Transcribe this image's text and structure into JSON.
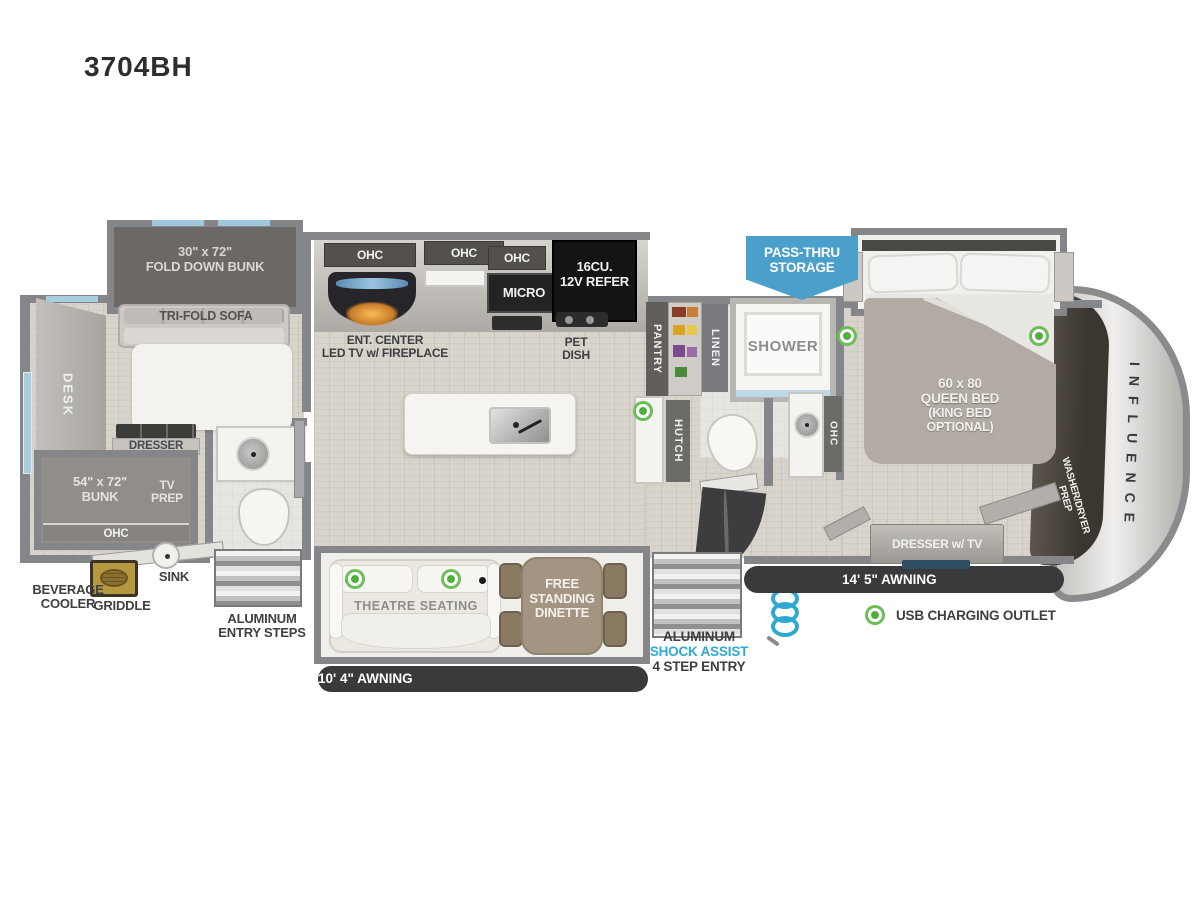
{
  "title": "3704BH",
  "colors": {
    "pass_thru_blue": "#4BA0CB",
    "outlet_green": "#4FAE3F",
    "shock_assist_blue": "#2FA9D2",
    "wall_gray": "#85868A",
    "awning_dark": "#3A3A3C"
  },
  "bunk_room": {
    "fold_down_bunk_l1": "30\" x 72\"",
    "fold_down_bunk_l2": "FOLD DOWN BUNK",
    "tri_fold_sofa": "TRI-FOLD SOFA",
    "desk": "DESK",
    "dresser": "DRESSER",
    "bunk_l1": "54\" x 72\"",
    "bunk_l2": "BUNK",
    "tv_prep_l1": "TV",
    "tv_prep_l2": "PREP",
    "ohc": "OHC"
  },
  "exterior_rear": {
    "beverage_cooler_l1": "BEVERAGE",
    "beverage_cooler_l2": "COOLER",
    "griddle": "GRIDDLE",
    "sink": "SINK",
    "entry_steps_l1": "ALUMINUM",
    "entry_steps_l2": "ENTRY STEPS"
  },
  "kitchen": {
    "ohc_left": "OHC",
    "ohc_mid": "OHC",
    "ohc_right": "OHC",
    "micro": "MICRO",
    "refer_l1": "16CU.",
    "refer_l2": "12V REFER",
    "ent_center_l1": "ENT. CENTER",
    "ent_center_l2": "LED TV w/ FIREPLACE",
    "pet_dish_l1": "PET",
    "pet_dish_l2": "DISH"
  },
  "mid_bath": {
    "pantry": "PANTRY",
    "linen": "LINEN",
    "shower": "SHOWER",
    "hutch": "HUTCH",
    "ohc": "OHC"
  },
  "living": {
    "theatre_seating": "THEATRE SEATING",
    "dinette_l1": "FREE",
    "dinette_l2": "STANDING",
    "dinette_l3": "DINETTE"
  },
  "storage": {
    "pass_thru_l1": "PASS-THRU",
    "pass_thru_l2": "STORAGE"
  },
  "entry": {
    "l1": "ALUMINUM",
    "l2": "SHOCK ASSIST",
    "l3": "4 STEP ENTRY"
  },
  "awnings": {
    "living": "10' 4\" AWNING",
    "main": "14' 5\" AWNING"
  },
  "bedroom": {
    "bed_l1": "60 x 80",
    "bed_l2": "QUEEN BED",
    "bed_l3": "(KING BED",
    "bed_l4": "OPTIONAL)",
    "dresser_tv": "DRESSER w/ TV",
    "washer_dryer_l1": "WASHER/DRYER",
    "washer_dryer_l2": "PREP",
    "brand": "INFLUENCE"
  },
  "legend": {
    "usb": "USB CHARGING OUTLET"
  }
}
